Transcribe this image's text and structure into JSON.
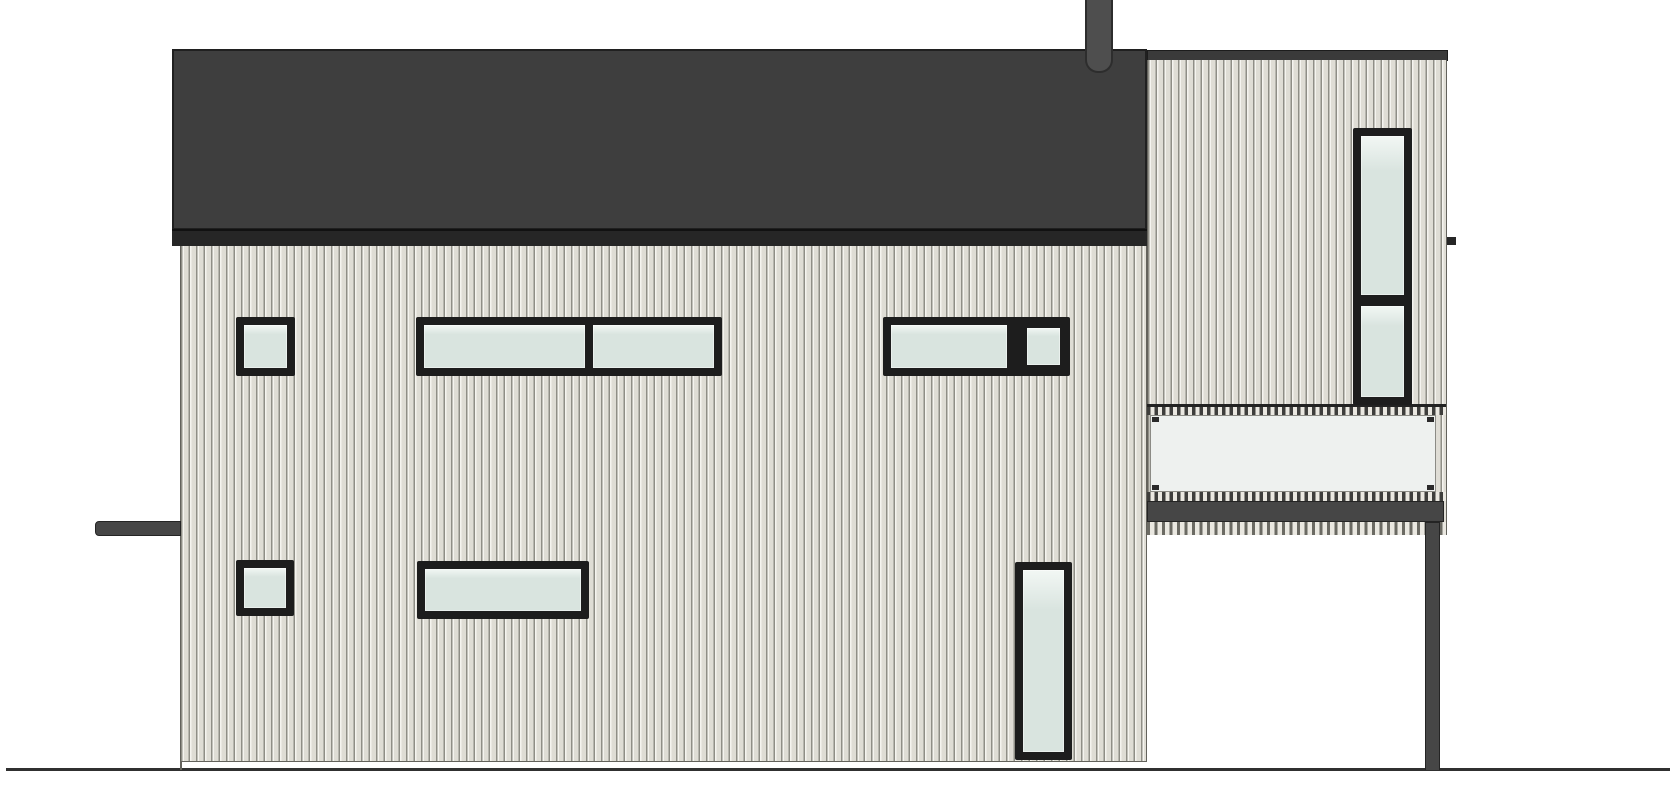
{
  "meta": {
    "drawing_type": "house-side-elevation",
    "canvas": {
      "w": 1670,
      "h": 800
    },
    "background": "#ffffff"
  },
  "palette": {
    "background": "#ffffff",
    "roof": "#3e3e3e",
    "roofEdge": "#202020",
    "fascia": "#262626",
    "chimney": "#4e4e4e",
    "chimneyEdge": "#2d2d2d",
    "sidingBase": "#dfddd5",
    "sidingLight": "#f5f4ef",
    "sidingGroove": "#8f8e86",
    "towerBand": "#3a3a3a",
    "frame": "#1d1d1d",
    "glass": "#d9e4df",
    "glassEdge": "#f2f7f4",
    "balconyGlass": "#eef1ef",
    "balconyGlassEdge": "#8b8b85",
    "metal": "#464646",
    "metalEdge": "#242424",
    "hatchDark": "#3e3e3c",
    "hatchMid": "#6b6a63",
    "hatchLight": "#eae8e1",
    "outline": "#63625c",
    "ground": "#303030"
  },
  "scene": {
    "parts": {
      "ground-line": {
        "x": 6,
        "y": 768,
        "w": 1664,
        "h": 3
      },
      "facade": {
        "x": 180,
        "y": 246,
        "w": 967,
        "h": 516
      },
      "facade-edge-tick": {
        "x": 180,
        "y": 762,
        "w": 2,
        "h": 8
      },
      "roof": {
        "x": 172,
        "y": 49,
        "w": 975,
        "h": 181
      },
      "roof-fascia": {
        "x": 172,
        "y": 229,
        "w": 976,
        "h": 17
      },
      "fascia-tick": {
        "x": 1447,
        "y": 237,
        "w": 9,
        "h": 8
      },
      "chimney": {
        "x": 1085,
        "y": 0,
        "w": 28,
        "h": 73
      },
      "tower-band": {
        "x": 1147,
        "y": 50,
        "w": 301,
        "h": 11
      },
      "tower-body": {
        "x": 1147,
        "y": 60,
        "w": 300,
        "h": 475
      },
      "balcony-rail": {
        "x": 1147,
        "y": 404,
        "w": 299,
        "h": 3
      },
      "balcony-balusters": {
        "x": 1147,
        "y": 407,
        "w": 299,
        "h": 8
      },
      "balcony-glass": {
        "x": 1150,
        "y": 415,
        "w": 286,
        "h": 77
      },
      "balcony-bottom-hatch": {
        "x": 1147,
        "y": 492,
        "w": 299,
        "h": 9
      },
      "balcony-deck": {
        "x": 1147,
        "y": 501,
        "w": 297,
        "h": 21
      },
      "balcony-lower-hatch": {
        "x": 1147,
        "y": 522,
        "w": 299,
        "h": 13
      },
      "balcony-post": {
        "x": 1425,
        "y": 522,
        "w": 15,
        "h": 248
      },
      "awning": {
        "x": 95,
        "y": 521,
        "w": 86,
        "h": 15
      }
    },
    "windows": [
      {
        "name": "upper-left-small",
        "x": 236,
        "y": 317,
        "w": 59,
        "h": 59,
        "glass": [
          {
            "x": 8,
            "y": 8,
            "w": 43,
            "h": 43
          }
        ]
      },
      {
        "name": "upper-middle-double",
        "x": 416,
        "y": 317,
        "w": 306,
        "h": 59,
        "glass": [
          {
            "x": 8,
            "y": 8,
            "w": 161,
            "h": 43
          },
          {
            "x": 177,
            "y": 8,
            "w": 121,
            "h": 43
          }
        ]
      },
      {
        "name": "upper-right-group",
        "x": 883,
        "y": 317,
        "w": 187,
        "h": 59,
        "glass": [
          {
            "x": 8,
            "y": 8,
            "w": 116,
            "h": 43
          },
          {
            "x": 144,
            "y": 11,
            "w": 33,
            "h": 37
          }
        ]
      },
      {
        "name": "lower-left-small",
        "x": 236,
        "y": 560,
        "w": 58,
        "h": 56,
        "glass": [
          {
            "x": 8,
            "y": 8,
            "w": 42,
            "h": 40
          }
        ]
      },
      {
        "name": "lower-middle-wide",
        "x": 417,
        "y": 561,
        "w": 172,
        "h": 58,
        "glass": [
          {
            "x": 8,
            "y": 8,
            "w": 156,
            "h": 42
          }
        ]
      },
      {
        "name": "lower-right-tall",
        "x": 1015,
        "y": 562,
        "w": 57,
        "h": 198,
        "glass": [
          {
            "x": 8,
            "y": 8,
            "w": 41,
            "h": 182
          }
        ]
      },
      {
        "name": "tower-tall",
        "x": 1353,
        "y": 128,
        "w": 59,
        "h": 277,
        "glass": [
          {
            "x": 8,
            "y": 8,
            "w": 43,
            "h": 159
          },
          {
            "x": 8,
            "y": 178,
            "w": 43,
            "h": 91
          }
        ]
      }
    ]
  }
}
